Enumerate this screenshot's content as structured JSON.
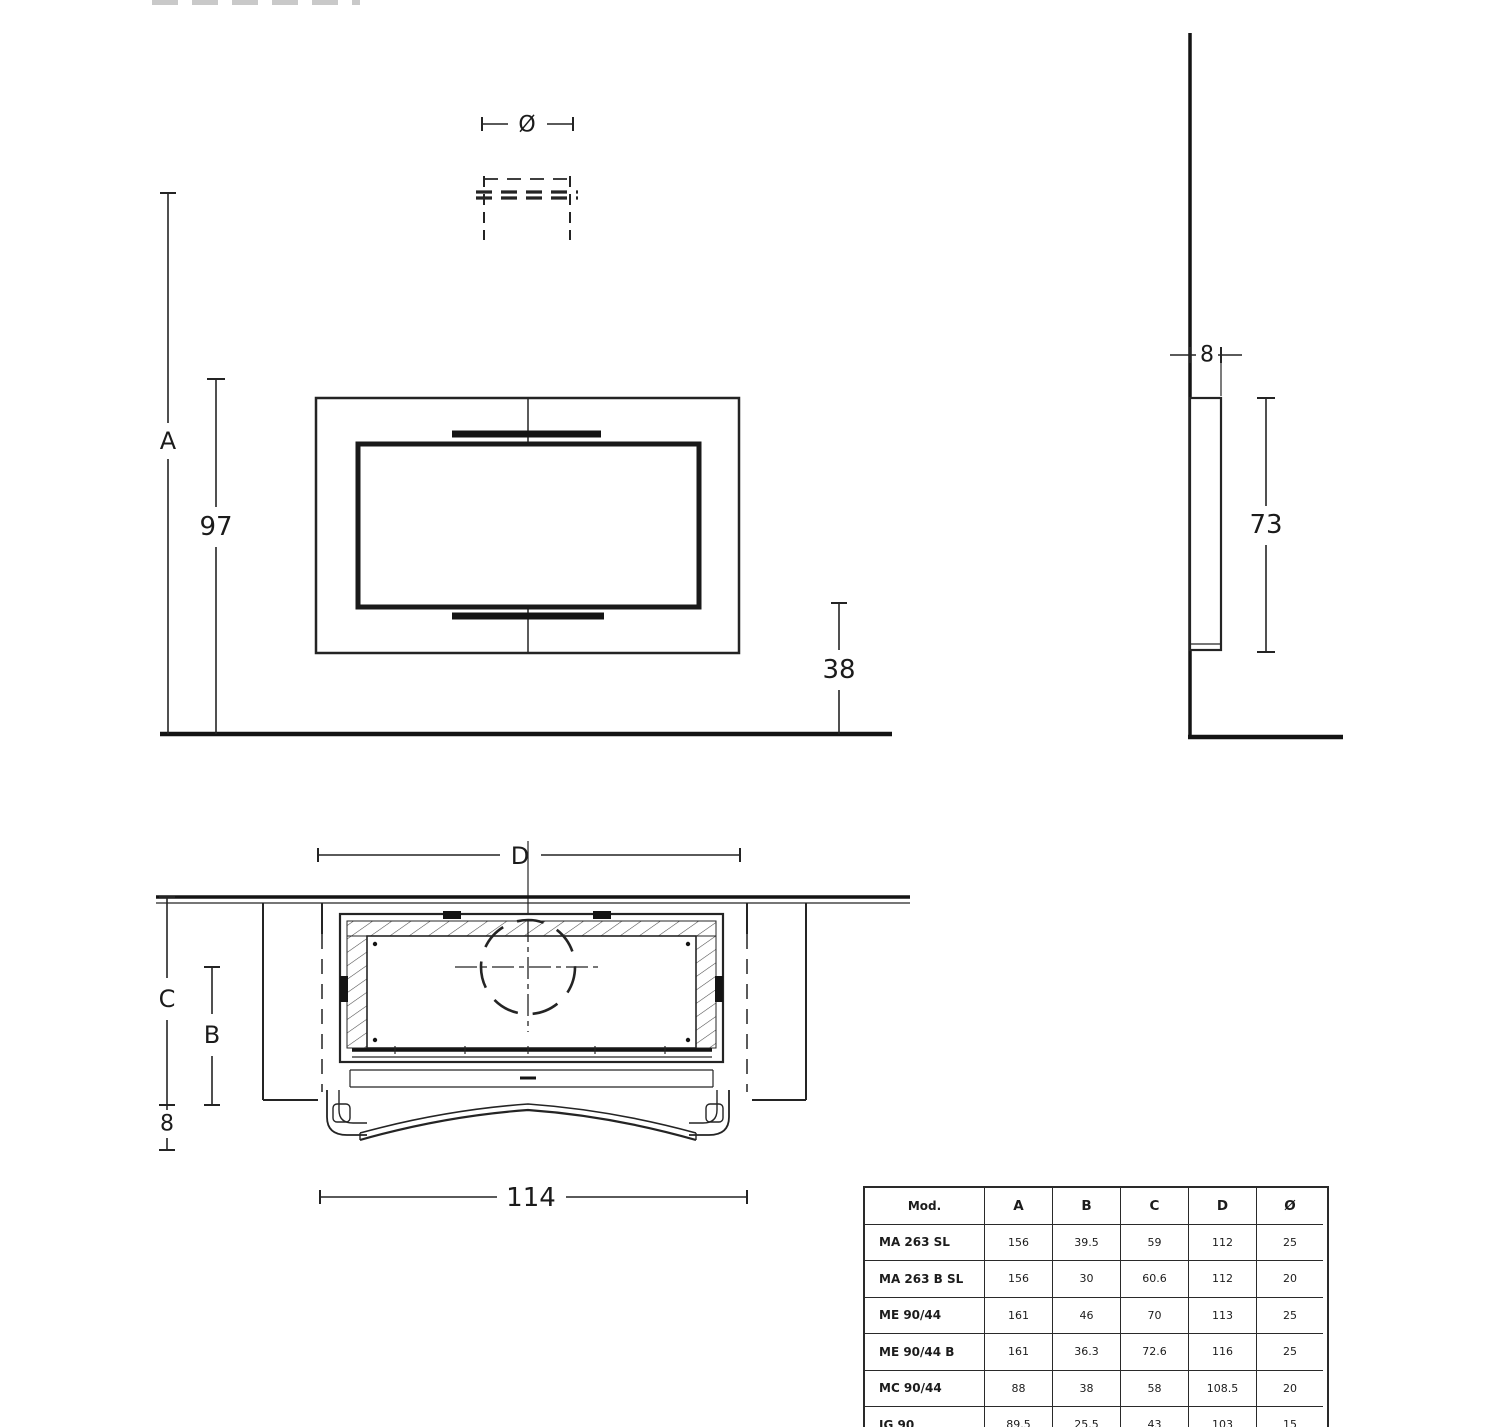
{
  "front_view": {
    "label_diameter": "Ø",
    "label_A": "A",
    "label_97": "97",
    "label_38": "38"
  },
  "side_view": {
    "label_8": "8",
    "label_73": "73"
  },
  "plan_view": {
    "label_D": "D",
    "label_C": "C",
    "label_B": "B",
    "label_8": "8",
    "label_114": "114"
  },
  "table": {
    "headers": [
      "Mod.",
      "A",
      "B",
      "C",
      "D",
      "Ø"
    ],
    "rows": [
      {
        "model": "MA 263 SL",
        "values": [
          "156",
          "39.5",
          "59",
          "112",
          "25"
        ]
      },
      {
        "model": "MA 263 B SL",
        "values": [
          "156",
          "30",
          "60.6",
          "112",
          "20"
        ]
      },
      {
        "model": "ME 90/44",
        "values": [
          "161",
          "46",
          "70",
          "113",
          "25"
        ]
      },
      {
        "model": "ME 90/44 B",
        "values": [
          "161",
          "36.3",
          "72.6",
          "116",
          "25"
        ]
      },
      {
        "model": "MC 90/44",
        "values": [
          "88",
          "38",
          "58",
          "108.5",
          "20"
        ]
      },
      {
        "model": "IG 90",
        "values": [
          "89.5",
          "25.5",
          "43",
          "103",
          "15"
        ]
      }
    ]
  },
  "colors": {
    "line": "#242424",
    "line_heavy": "#141414",
    "background": "#ffffff"
  }
}
